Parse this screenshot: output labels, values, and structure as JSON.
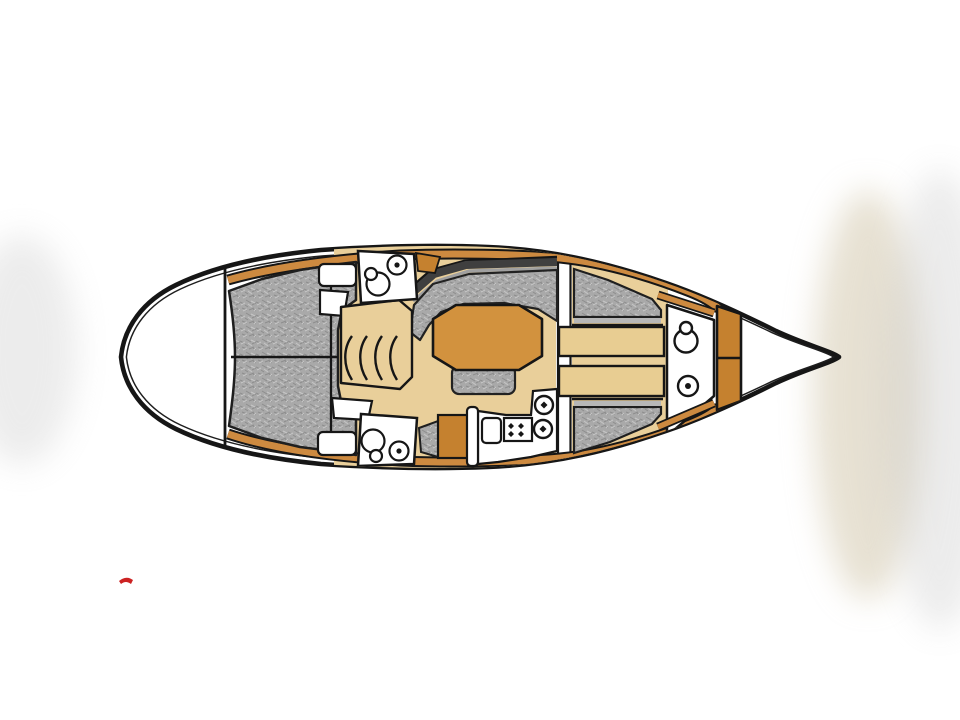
{
  "diagram": {
    "type": "sailboat-interior-floor-plan",
    "orientation": "bow-left-stern-right",
    "areas": [
      "anchor-locker",
      "v-berth-cabin",
      "head-top",
      "head-bottom",
      "salon",
      "galley",
      "aft-berth-top",
      "aft-berth-bottom",
      "cockpit-helm",
      "stern-peak"
    ],
    "fixture_icons": [
      "toilet-icon",
      "sink-icon",
      "stove-burners-icon",
      "round-sink-icon",
      "steering-wheel-icon",
      "binnacle-icon",
      "salon-table",
      "settee-cushion",
      "berth-cushion",
      "companionway-steps"
    ]
  },
  "colors": {
    "line": "#161616",
    "hull_fill": "#ffffff",
    "white": "#ffffff",
    "floor": "#e9cf9a",
    "bench": "#e8cd92",
    "table": "#d2923e",
    "trim": "#cd8a40",
    "trim_deep": "#c5812f",
    "upholstery": "#a9a9a9",
    "upholstery_strip": "#b7b7b7",
    "coaming_dark": "#3f3f3f",
    "coaming_mid": "#a0a0a0",
    "red_mark": "#cc2222",
    "haze_warm": "#cfc3a6",
    "haze_gray": "#c9c9c9"
  }
}
